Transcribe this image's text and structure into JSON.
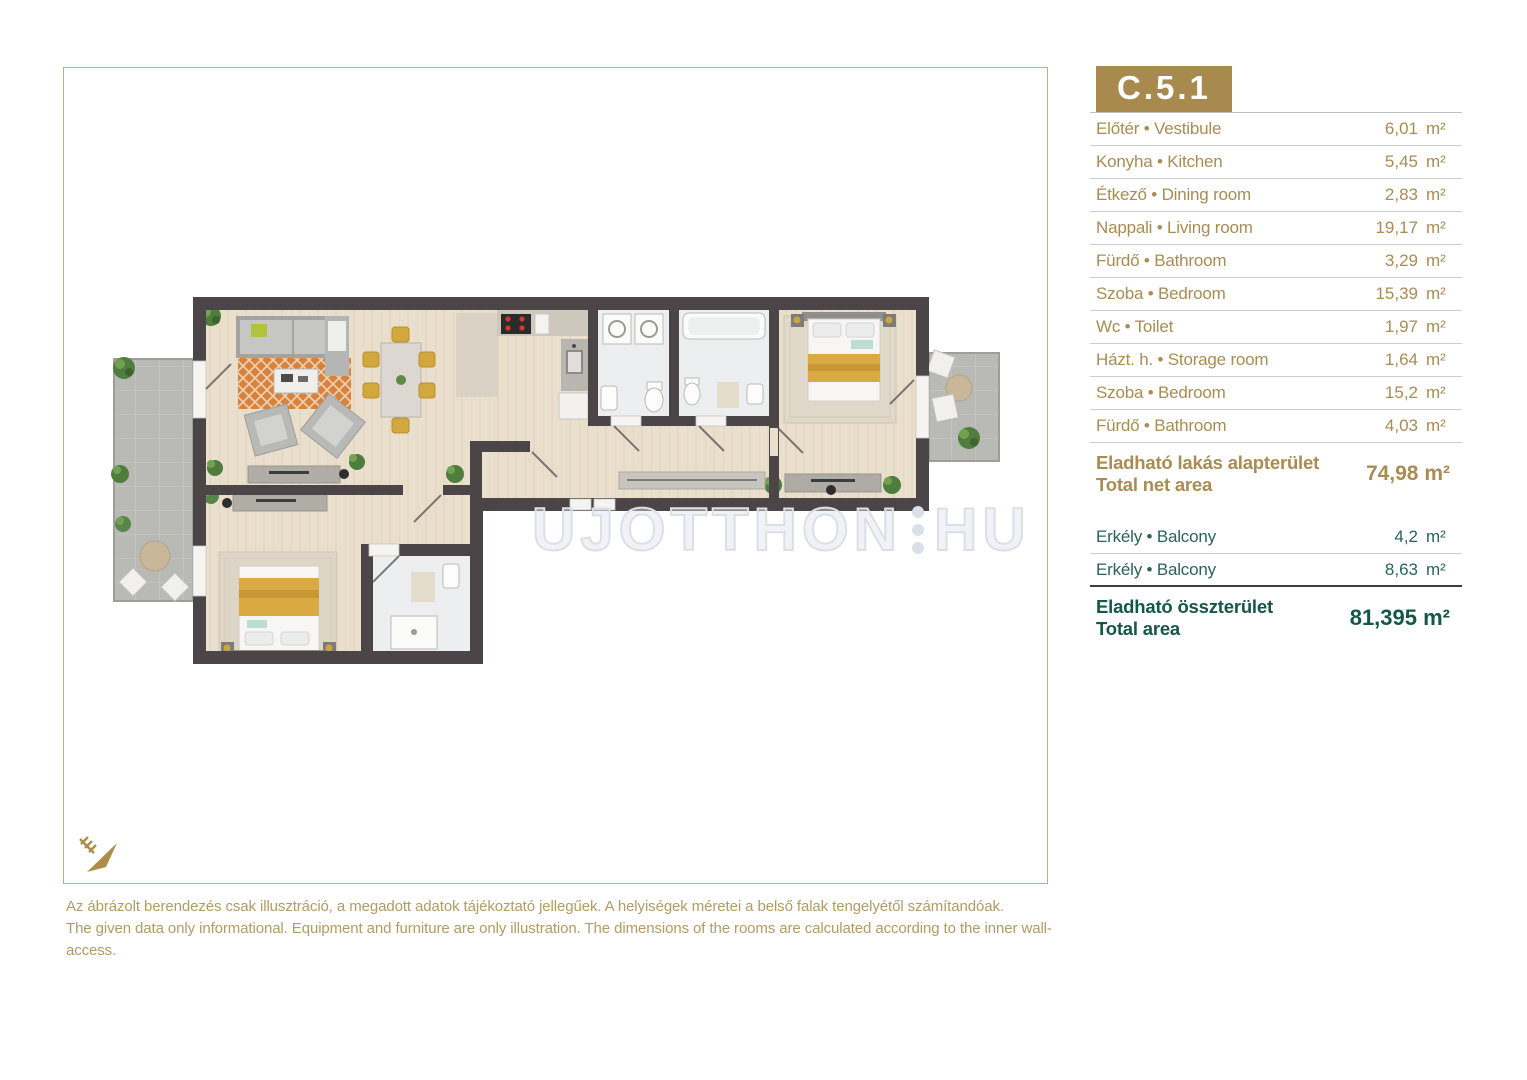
{
  "unit": {
    "code": "C.5.1"
  },
  "room_table": {
    "rows": [
      {
        "label": "Előtér • Vestibule",
        "value": "6,01",
        "unit": "m²"
      },
      {
        "label": "Konyha • Kitchen",
        "value": "5,45",
        "unit": "m²"
      },
      {
        "label": "Étkező • Dining room",
        "value": "2,83",
        "unit": "m²"
      },
      {
        "label": "Nappali • Living room",
        "value": "19,17",
        "unit": "m²"
      },
      {
        "label": "Fürdő • Bathroom",
        "value": "3,29",
        "unit": "m²"
      },
      {
        "label": "Szoba • Bedroom",
        "value": "15,39",
        "unit": "m²"
      },
      {
        "label": "Wc • Toilet",
        "value": "1,97",
        "unit": "m²"
      },
      {
        "label": "Házt. h. • Storage room",
        "value": "1,64",
        "unit": "m²"
      },
      {
        "label": "Szoba • Bedroom",
        "value": "15,2",
        "unit": "m²"
      },
      {
        "label": "Fürdő • Bathroom",
        "value": "4,03",
        "unit": "m²"
      }
    ],
    "net_area": {
      "label_hu": "Eladható lakás alapterület",
      "label_en": "Total net area",
      "value": "74,98 m²"
    },
    "balcony_rows": [
      {
        "label": "Erkély • Balcony",
        "value": "4,2",
        "unit": "m²"
      },
      {
        "label": "Erkély • Balcony",
        "value": "8,63",
        "unit": "m²"
      }
    ],
    "total_area": {
      "label_hu": "Eladható összterület",
      "label_en": "Total area",
      "value": "81,395 m²"
    }
  },
  "watermark": {
    "left": "UJOTTHON",
    "right": "HU"
  },
  "disclaimer": {
    "line1": "Az ábrázolt berendezés csak illusztráció, a megadott adatok tájékoztató jellegűek. A helyiségek méretei a belső falak tengelyétől számítandóak.",
    "line2": "The given data only informational. Equipment and furniture are only illustration. The dimensions of the rooms are calculated according to the inner wall-access."
  },
  "colors": {
    "gold": "#a98c52",
    "gold_box": "#a8894e",
    "green": "#2a6456",
    "green_dark": "#135843",
    "wall": "#4b4547",
    "wood": "#eadfcd",
    "balcony_floor": "#b9b9b5"
  }
}
